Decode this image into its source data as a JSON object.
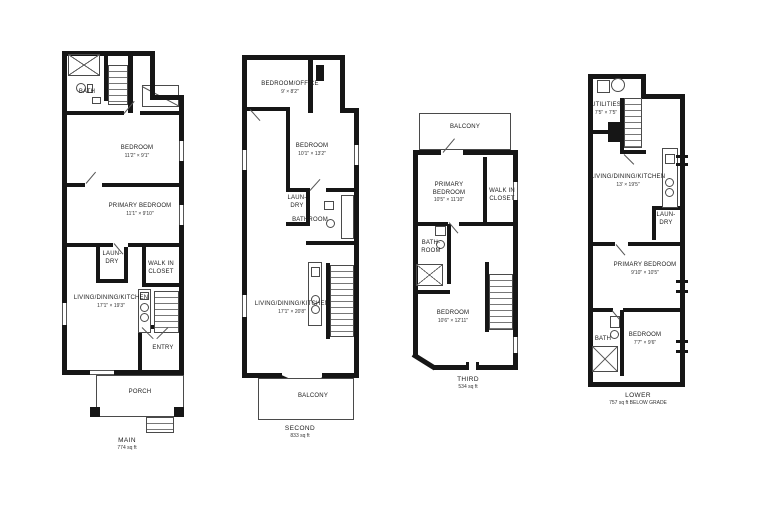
{
  "drawing": {
    "wall_color": "#161616",
    "line_color": "#4a4a4a",
    "background": "#ffffff"
  },
  "plans": [
    {
      "title": "MAIN",
      "area": "774 sq ft",
      "rooms": [
        {
          "name": "BATH",
          "dims": ""
        },
        {
          "name": "BEDROOM",
          "dims": "11'2\" × 9'1\""
        },
        {
          "name": "PRIMARY BEDROOM",
          "dims": "11'1\" × 9'10\""
        },
        {
          "name": "LAUN-DRY",
          "dims": ""
        },
        {
          "name": "WALK IN CLOSET",
          "dims": ""
        },
        {
          "name": "LIVING/DINING/KITCHEN",
          "dims": "17'1\" × 19'3\""
        },
        {
          "name": "ENTRY",
          "dims": ""
        },
        {
          "name": "PORCH",
          "dims": ""
        }
      ]
    },
    {
      "title": "SECOND",
      "area": "833 sq ft",
      "rooms": [
        {
          "name": "BEDROOM/OFFICE",
          "dims": "9' × 8'2\""
        },
        {
          "name": "BEDROOM",
          "dims": "10'1\" × 13'2\""
        },
        {
          "name": "LAUN-DRY",
          "dims": ""
        },
        {
          "name": "BATHROOM",
          "dims": ""
        },
        {
          "name": "LIVING/DINING/KITCHEN",
          "dims": "17'1\" × 20'8\""
        },
        {
          "name": "BALCONY",
          "dims": ""
        }
      ]
    },
    {
      "title": "THIRD",
      "area": "534 sq ft",
      "rooms": [
        {
          "name": "BALCONY",
          "dims": ""
        },
        {
          "name": "PRIMARY BEDROOM",
          "dims": "10'5\" × 11'10\""
        },
        {
          "name": "WALK IN CLOSET",
          "dims": ""
        },
        {
          "name": "BATH-ROOM",
          "dims": ""
        },
        {
          "name": "BEDROOM",
          "dims": "10'6\" × 12'11\""
        }
      ]
    },
    {
      "title": "LOWER",
      "area": "757 sq ft BELOW GRADE",
      "rooms": [
        {
          "name": "UTILITIES",
          "dims": "7'5\" × 7'5\""
        },
        {
          "name": "LIVING/DINING/KITCHEN",
          "dims": "13' × 19'5\""
        },
        {
          "name": "LAUN-DRY",
          "dims": ""
        },
        {
          "name": "PRIMARY BEDROOM",
          "dims": "9'10\" × 10'5\""
        },
        {
          "name": "BATH",
          "dims": ""
        },
        {
          "name": "BEDROOM",
          "dims": "7'7\" × 9'6\""
        }
      ]
    }
  ]
}
